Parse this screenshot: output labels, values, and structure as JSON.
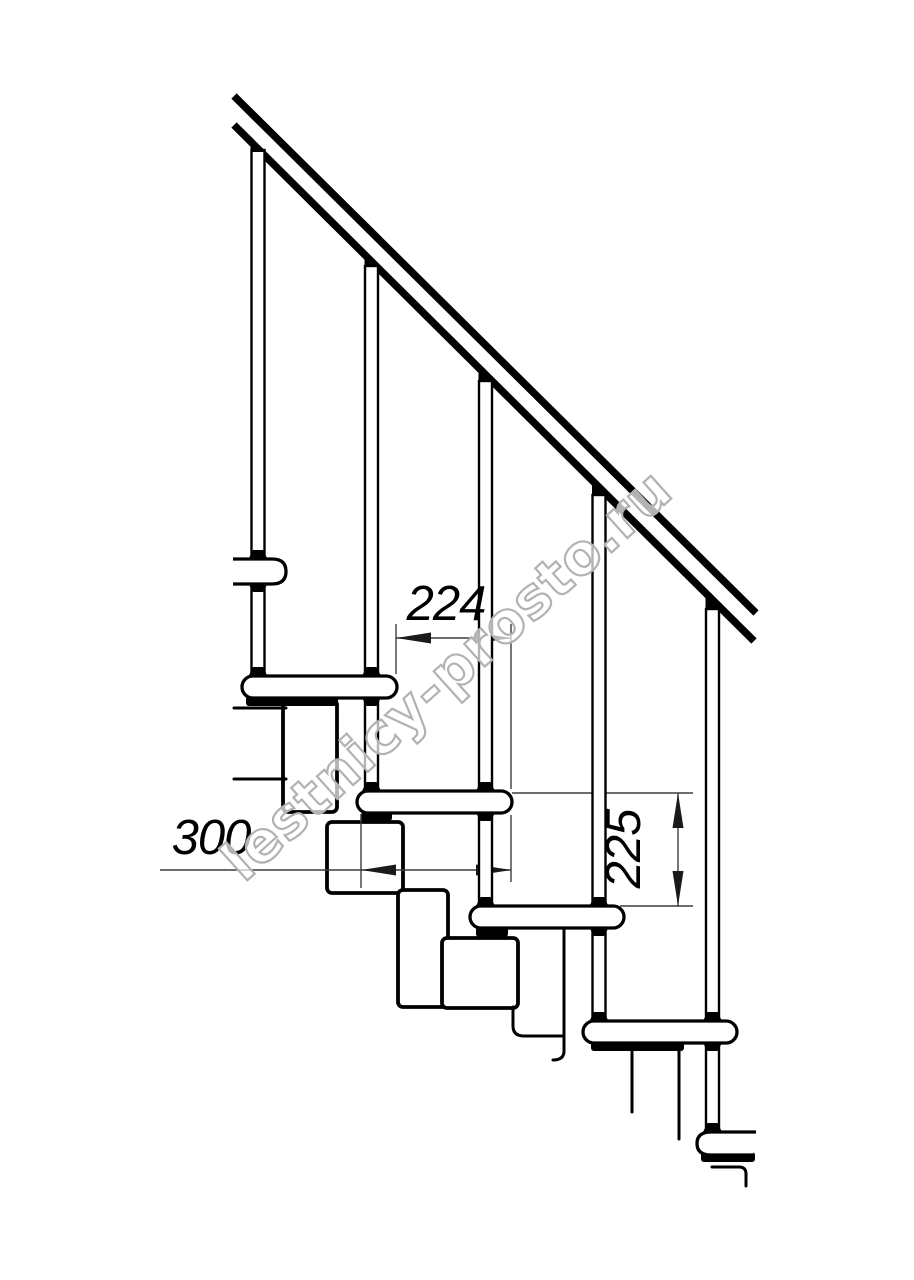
{
  "dimensions": {
    "step_run": "224",
    "tread_depth": "300",
    "step_rise": "225"
  },
  "watermark": {
    "text": "lestnicy-prosto.ru"
  },
  "colors": {
    "line": "#000000",
    "dimension_line": "#3d3d3d",
    "watermark_stroke": "#b2b2b2",
    "background": "#ffffff"
  }
}
